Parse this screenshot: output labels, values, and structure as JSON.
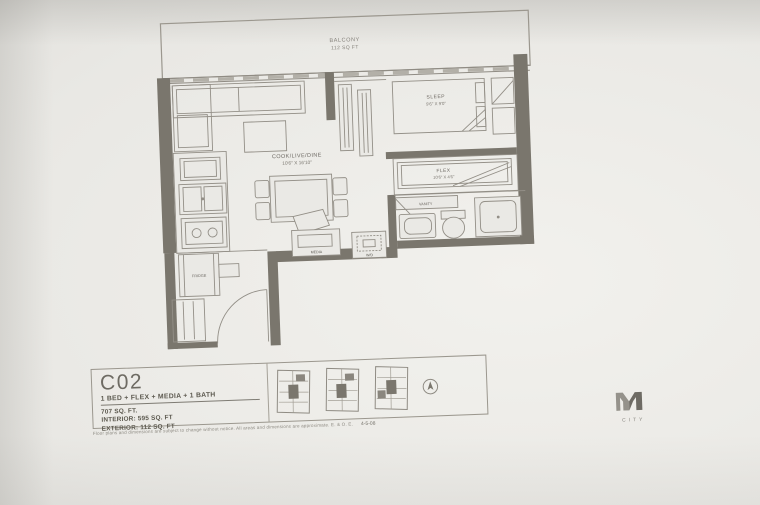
{
  "photo": {
    "paper_color": "#e9e8e4",
    "wall_color": "#7a766d",
    "line_color": "#938f87",
    "text_color": "#6d6963"
  },
  "plan": {
    "balcony": {
      "title": "BALCONY",
      "area": "112 SQ FT"
    },
    "sleep": {
      "label": "SLEEP",
      "dims": "9'6\" X 9'0\""
    },
    "cook_live_dine": {
      "label": "COOK/LIVE/DINE",
      "dims": "10'6\" X 16'10\""
    },
    "flex": {
      "label": "FLEX",
      "dims": "10'6\" X 4'6\""
    },
    "vanity_label": "VANITY",
    "wd_label": "W/D",
    "fridge_label": "FRIDGE",
    "media_label": "MEDIA"
  },
  "info": {
    "unit_code": "C02",
    "unit_type": "1 BED + FLEX + MEDIA + 1 BATH",
    "area_total": "707 SQ. FT.",
    "area_interior": "INTERIOR: 595 SQ. FT",
    "area_exterior": "EXTERIOR: 112 SQ. FT",
    "disclaimer": "Floor plans and dimensions are subject to change without notice. All areas and dimensions are approximate. E. & O. E.",
    "plan_code": "4-5-08"
  },
  "logo": {
    "word": "CITY"
  }
}
